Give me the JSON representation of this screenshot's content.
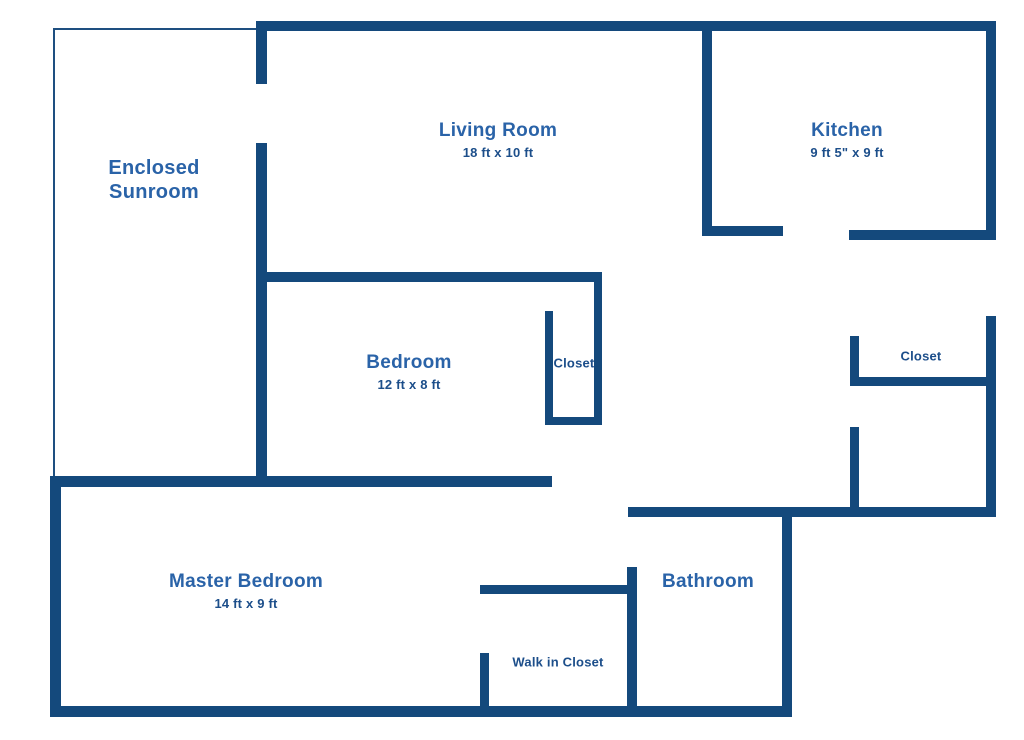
{
  "colors": {
    "wall": "#14497C",
    "thin_line": "#1E4F80",
    "room_title": "#2A63A8",
    "room_dims": "#1C4E8A",
    "background": "#FFFFFF"
  },
  "rooms": {
    "enclosed_sunroom": {
      "name_line1": "Enclosed",
      "name_line2": "Sunroom"
    },
    "living_room": {
      "name": "Living Room",
      "dims": "18 ft x 10 ft"
    },
    "kitchen": {
      "name": "Kitchen",
      "dims": "9 ft 5\" x 9 ft"
    },
    "bedroom": {
      "name": "Bedroom",
      "dims": "12 ft x 8 ft"
    },
    "bedroom_closet": {
      "name": "Closet"
    },
    "hall_closet": {
      "name": "Closet"
    },
    "master_bedroom": {
      "name": "Master Bedroom",
      "dims": "14 ft x 9 ft"
    },
    "bathroom": {
      "name": "Bathroom"
    },
    "walk_in_closet": {
      "name": "Walk in Closet"
    }
  }
}
